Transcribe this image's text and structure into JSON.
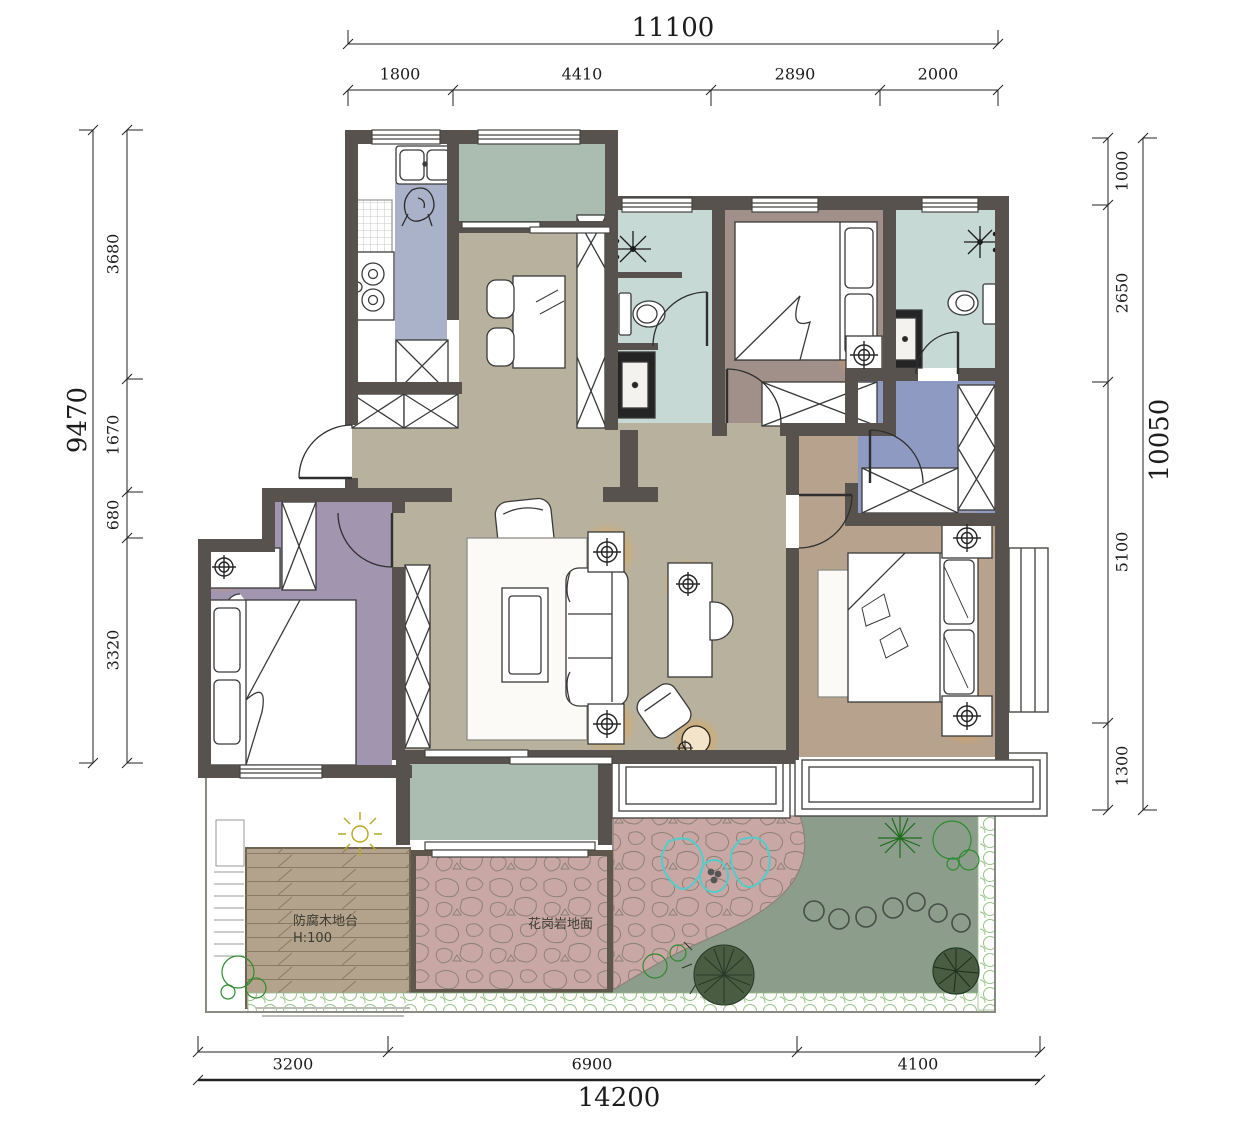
{
  "drawing": {
    "type": "residential floor plan with garden",
    "annotations": {
      "deck_line1": "防腐木地台",
      "deck_line2": "H:100",
      "granite_label": "花岗岩地面"
    },
    "dimensions": {
      "top": {
        "total": "11100",
        "segments": [
          "1800",
          "4410",
          "2890",
          "2000"
        ]
      },
      "left": {
        "total": "9470",
        "segments": [
          "3680",
          "1670",
          "680",
          "3320"
        ]
      },
      "right": {
        "total": "10050",
        "segments": [
          "1000",
          "2650",
          "5100",
          "1300"
        ]
      },
      "bottom": {
        "total": "14200",
        "segments": [
          "3200",
          "6900",
          "4100"
        ]
      }
    },
    "colors": {
      "wall": "#57524d",
      "living_floor": "#b8b19d",
      "kitchen_floor": "#a9b2c8",
      "bath_floor": "#c6d9d5",
      "bedroom_north_floor": "#a19089",
      "master_floor": "#b7a28e",
      "bedroom_west_floor": "#a195b0",
      "closet_floor": "#8f9ac3",
      "balcony_floor": "#aabdb0",
      "lawn": "#8d9d8b",
      "granite": "#c9a7a5",
      "deck": "#b4a38c",
      "lamp_glow": "#f0a43e",
      "hedge": "#98c488",
      "outdoor_chair_outline": "#5cc9c9",
      "tree_green": "#2e8b2e",
      "dim_text": "#1c1c1c"
    }
  }
}
